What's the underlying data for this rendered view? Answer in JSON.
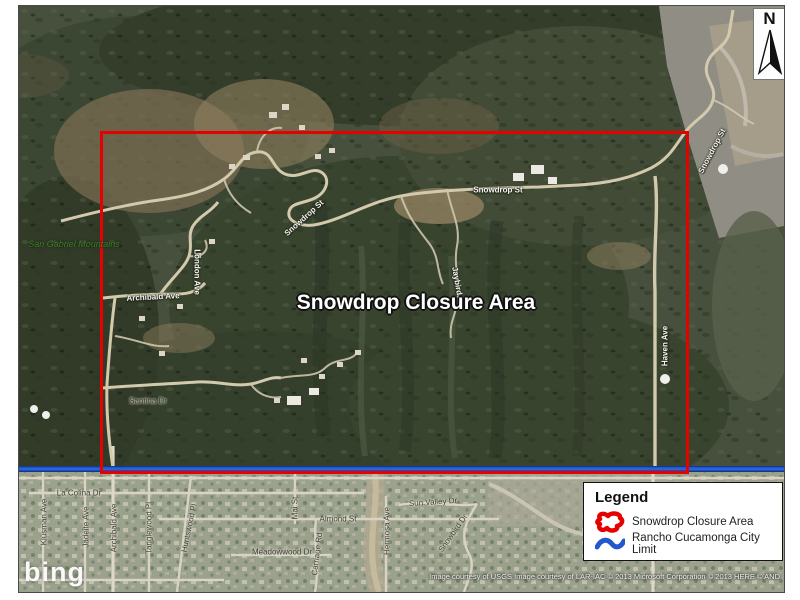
{
  "map": {
    "closure_label": "Snowdrop Closure Area",
    "region_label": "San Gabriel Mountains",
    "north_label": "N",
    "logo": "bing",
    "attribution": "Image courtesy of USGS Image courtesy of LAR-IAC © 2013 Microsoft Corporation © 2013 HERE © AND",
    "colors": {
      "closure_outline": "#e60000",
      "city_limit": "#2158cc"
    },
    "road_labels": [
      {
        "text": "Snowdrop St"
      },
      {
        "text": "Snowdrop St"
      },
      {
        "text": "Snowdrop St"
      },
      {
        "text": "London Ave"
      },
      {
        "text": "Archibald Ave"
      },
      {
        "text": "Jaybird"
      },
      {
        "text": "Haven Ave"
      },
      {
        "text": "Santina Dr"
      },
      {
        "text": "La Colina Dr"
      },
      {
        "text": "Klusman Ave"
      },
      {
        "text": "Jadeite Ave"
      },
      {
        "text": "Archibald Ave"
      },
      {
        "text": "Tanglewood Pl"
      },
      {
        "text": "Huntswood Pl"
      },
      {
        "text": "Mai St"
      },
      {
        "text": "Almond St"
      },
      {
        "text": "Meadowwood Dr"
      },
      {
        "text": "Carriage Rd"
      },
      {
        "text": "Sun Valley Dr"
      },
      {
        "text": "Hermosa Ave"
      },
      {
        "text": "Snowbird Dr"
      }
    ]
  },
  "legend": {
    "title": "Legend",
    "items": [
      {
        "label": "Snowdrop Closure Area",
        "color": "#e60000"
      },
      {
        "label": "Rancho Cucamonga City Limit",
        "color": "#2158cc"
      }
    ]
  }
}
